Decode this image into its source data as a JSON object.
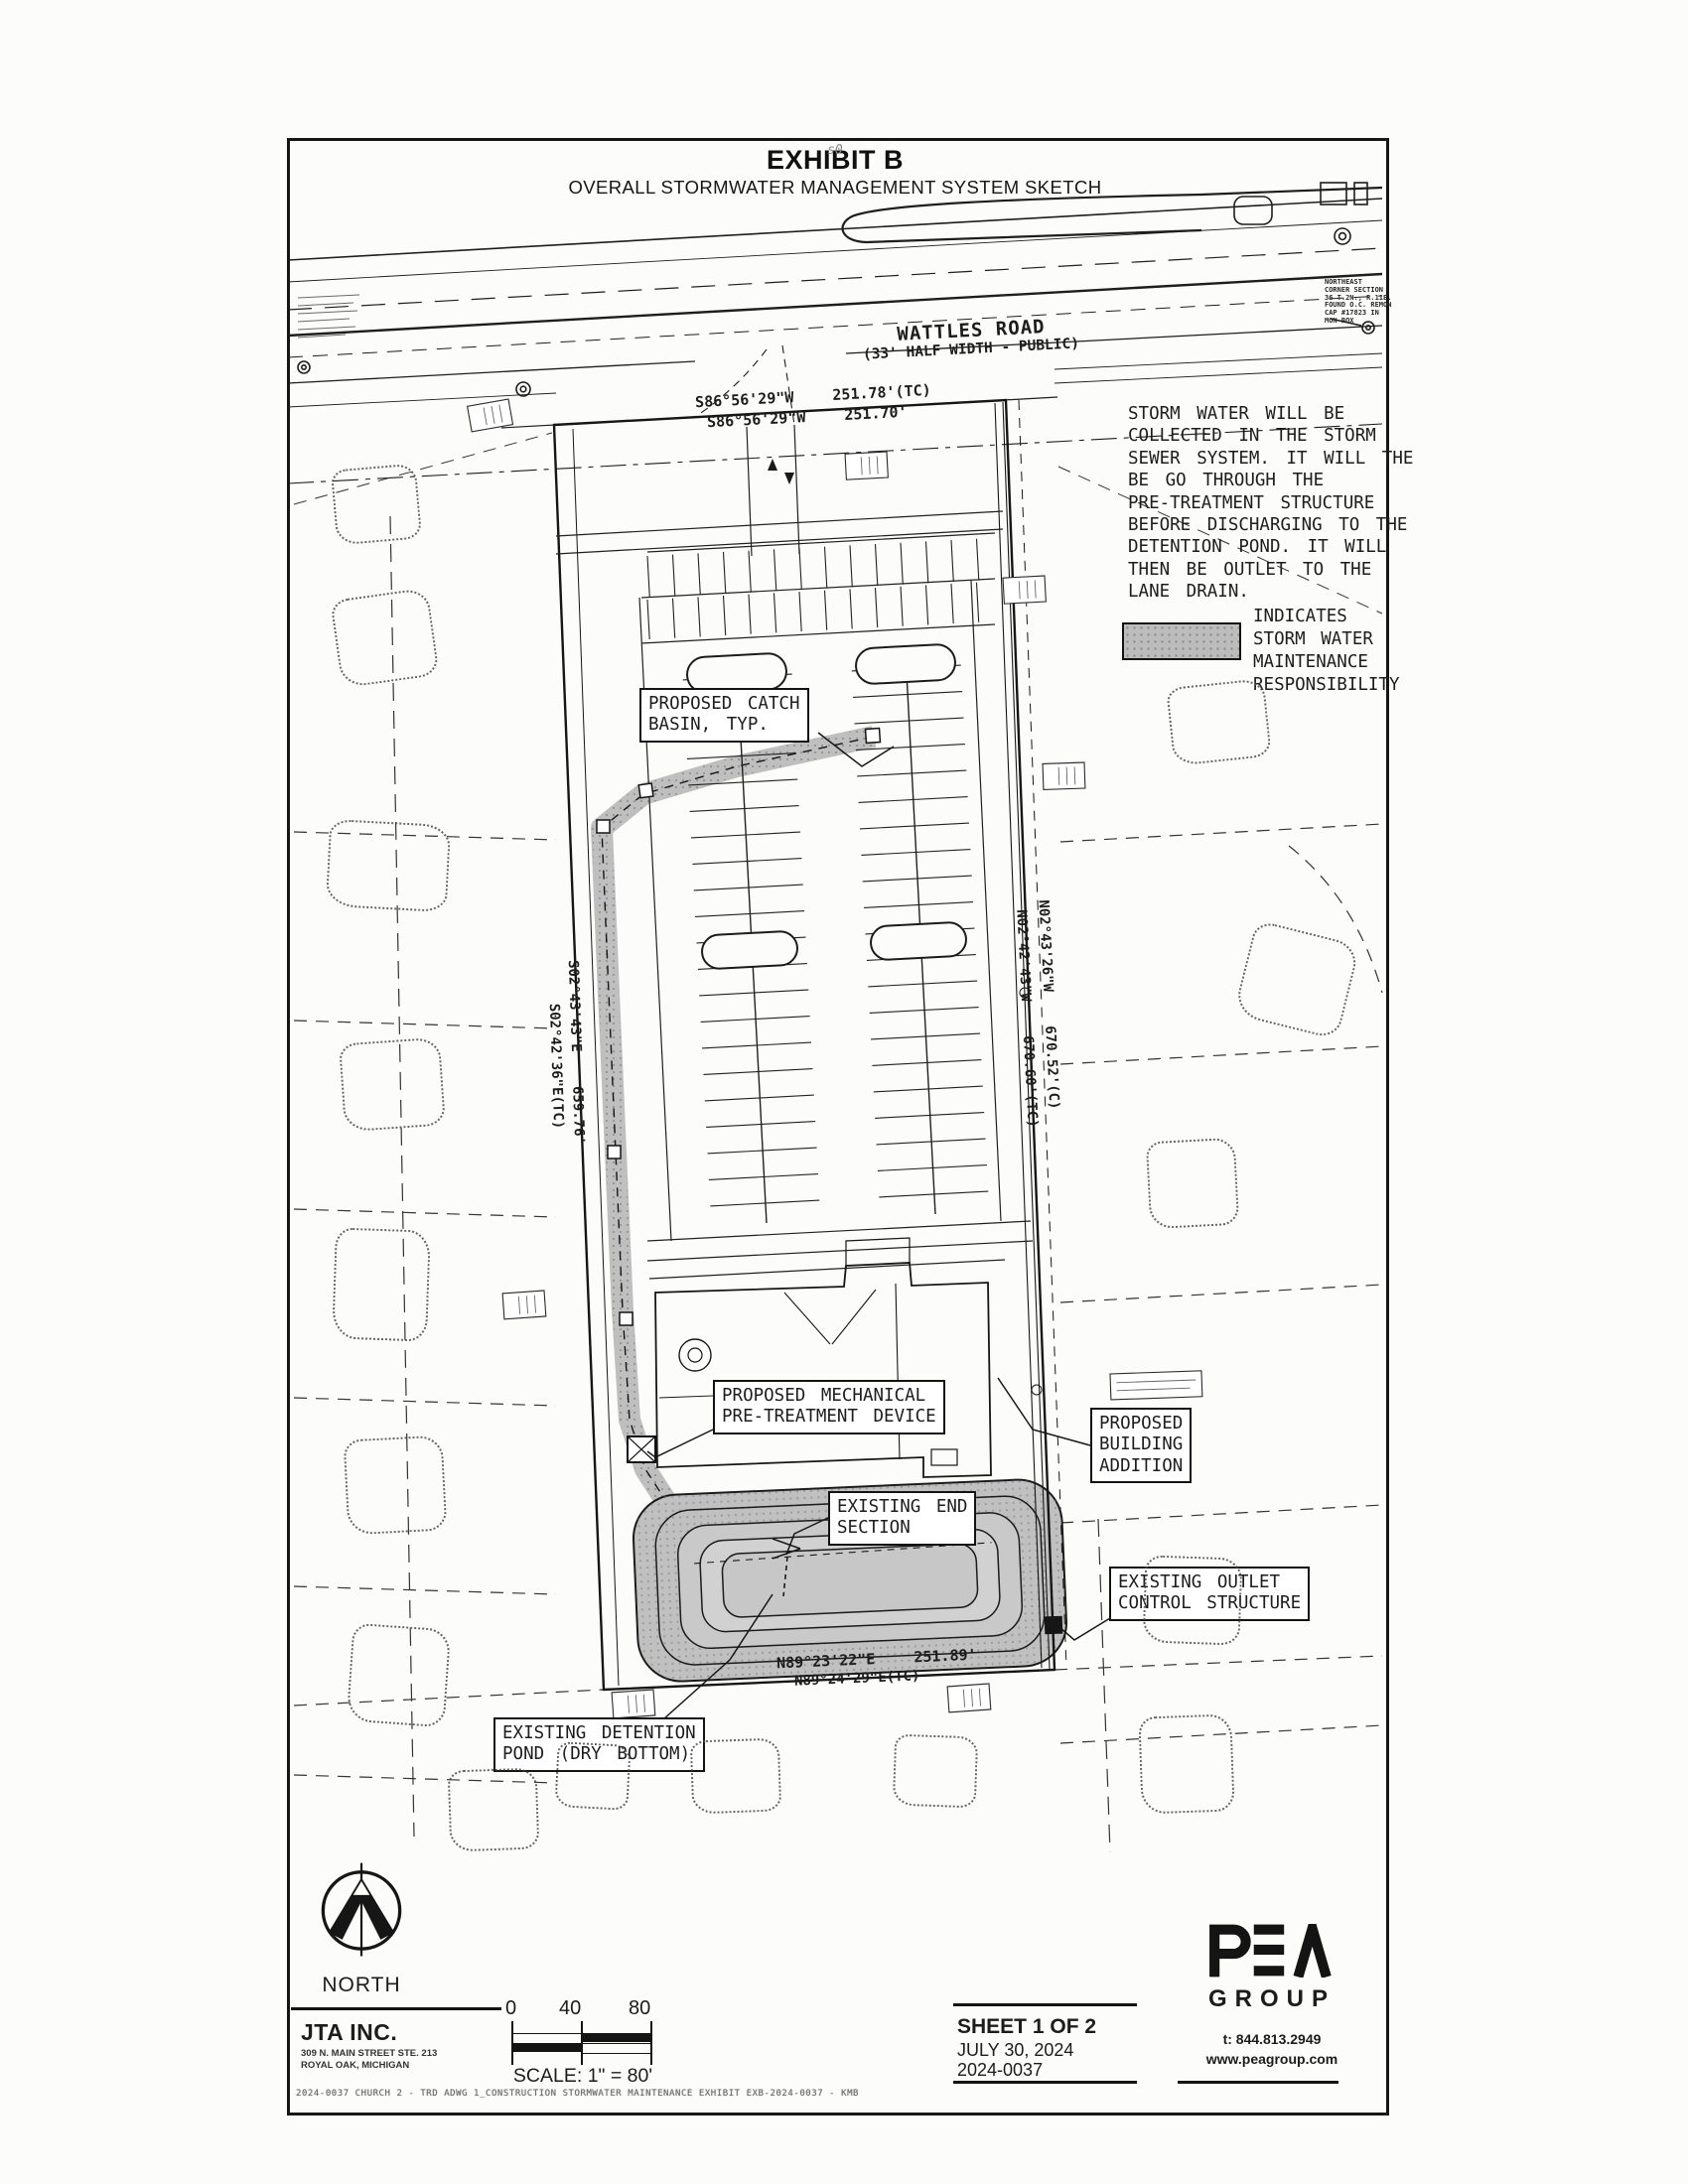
{
  "sheet": {
    "title": "EXHIBIT B",
    "subtitle": "OVERALL STORMWATER MANAGEMENT SYSTEM SKETCH",
    "mark": "s0"
  },
  "road": {
    "name": "WATTLES ROAD",
    "detail": "(33' HALF WIDTH - PUBLIC)"
  },
  "bearings": {
    "north_tc": "S86°56'29\"W   251.78'(TC)",
    "north": "S86°56'29\"W   251.70'",
    "east_c": "N02°43'26\"W   670.52'(C)",
    "east_tc": "N02°42'43\"W   670.60'(TC)",
    "west": "S02°43'43\"E   659.76'",
    "west_tc": "S02°42'36\"E(TC)",
    "south": "N89°23'22\"E   251.89'",
    "south_tc": "N89°24'29\"E(TC)"
  },
  "note": {
    "lines": [
      "STORM WATER WILL BE",
      "COLLECTED IN THE STORM",
      "SEWER SYSTEM. IT WILL THE",
      "BE GO THROUGH THE",
      "PRE-TREATMENT STRUCTURE",
      "BEFORE DISCHARGING TO THE",
      "DETENTION POND. IT WILL",
      "THEN BE OUTLET TO THE",
      "LANE DRAIN."
    ]
  },
  "legend": {
    "swatch_color": "#bcbcbc",
    "lines": [
      "INDICATES",
      "STORM WATER",
      "MAINTENANCE",
      "RESPONSIBILITY"
    ]
  },
  "callouts": {
    "catch_basin": {
      "l1": "PROPOSED CATCH",
      "l2": "BASIN, TYP."
    },
    "pretreatment": {
      "l1": "PROPOSED MECHANICAL",
      "l2": "PRE-TREATMENT DEVICE"
    },
    "building_addition": {
      "l1": "PROPOSED",
      "l2": "BUILDING",
      "l3": "ADDITION"
    },
    "end_section": {
      "l1": "EXISTING END",
      "l2": "SECTION"
    },
    "outlet": {
      "l1": "EXISTING OUTLET",
      "l2": "CONTROL STRUCTURE"
    },
    "detention_pond": {
      "l1": "EXISTING DETENTION",
      "l2": "POND (DRY BOTTOM)"
    }
  },
  "survey_note": {
    "lines": [
      "NORTHEAST",
      "CORNER SECTION",
      "36 T.2N., R.11E.",
      "FOUND O.C. REMON",
      "CAP #17823 IN",
      "MON BOX"
    ]
  },
  "titleblock": {
    "north_label": "NORTH",
    "firm_name": "JTA INC.",
    "firm_address1": "309 N. MAIN STREET STE. 213",
    "firm_address2": "ROYAL OAK, MICHIGAN",
    "scale_0": "0",
    "scale_40": "40",
    "scale_80": "80",
    "scale_label": "SCALE: 1\" = 80'",
    "sheet_no": "SHEET 1 OF 2",
    "date": "JULY 30, 2024",
    "project_no": "2024-0037",
    "brand_name": "PEA",
    "brand_group": "GROUP",
    "brand_phone": "t: 844.813.2949",
    "brand_web": "www.peagroup.com",
    "fineprint": "2024-0037 CHURCH 2 - TRD ADWG 1_CONSTRUCTION STORMWATER MAINTENANCE EXHIBIT EXB-2024-0037 - KMB"
  }
}
